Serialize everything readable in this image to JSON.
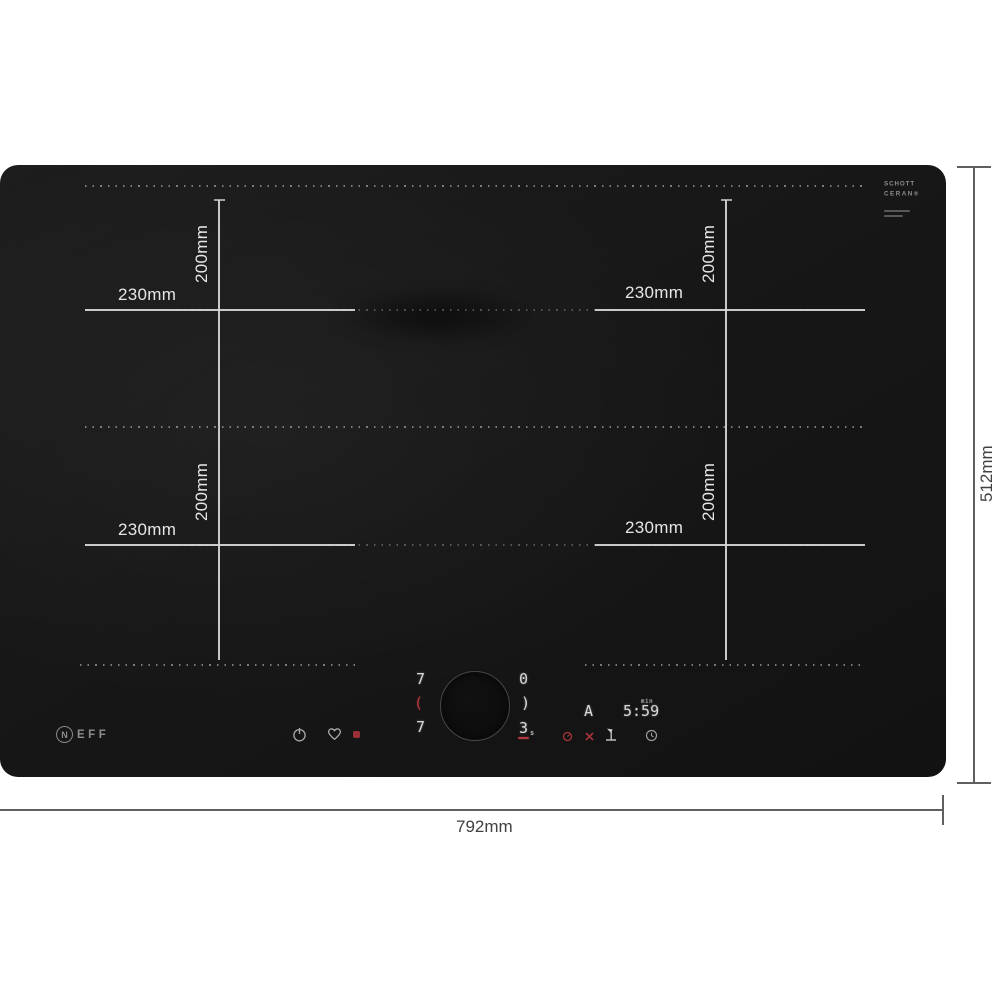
{
  "colors": {
    "hob_black": "#171717",
    "measure_line": "#d8d8d8",
    "accent_red": "#b03a3f",
    "digit_gray": "#d9d9d9",
    "dimension_text": "#414141"
  },
  "branding": {
    "neff_initial": "N",
    "neff_rest": "EFF",
    "glass_line1": "SCHOTT",
    "glass_line2": "CERAN®"
  },
  "zones": [
    {
      "position": "top-left",
      "width_label": "230mm",
      "height_label": "200mm"
    },
    {
      "position": "top-right",
      "width_label": "230mm",
      "height_label": "200mm"
    },
    {
      "position": "bottom-left",
      "width_label": "230mm",
      "height_label": "200mm"
    },
    {
      "position": "bottom-right",
      "width_label": "230mm",
      "height_label": "200mm"
    }
  ],
  "overall_dimensions": {
    "width_label": "792mm",
    "depth_label": "512mm"
  },
  "control_panel": {
    "left_zone_display": {
      "top": "7",
      "mid": "(",
      "bottom": "7"
    },
    "right_zone_display": {
      "top": "0",
      "mid": ")",
      "bottom": "3",
      "bottom_sub": "s"
    },
    "auto_indicator": "A",
    "timer": {
      "value": "5:59",
      "unit": "min"
    },
    "icons": {
      "power": "power-icon",
      "favorite": "heart-icon",
      "favorite_active": "red-dot-icon",
      "function_red_1": "red-gauge-icon",
      "function_red_2": "red-cross-icon",
      "utensil": "flag-icon",
      "timer_clock": "clock-icon"
    }
  }
}
